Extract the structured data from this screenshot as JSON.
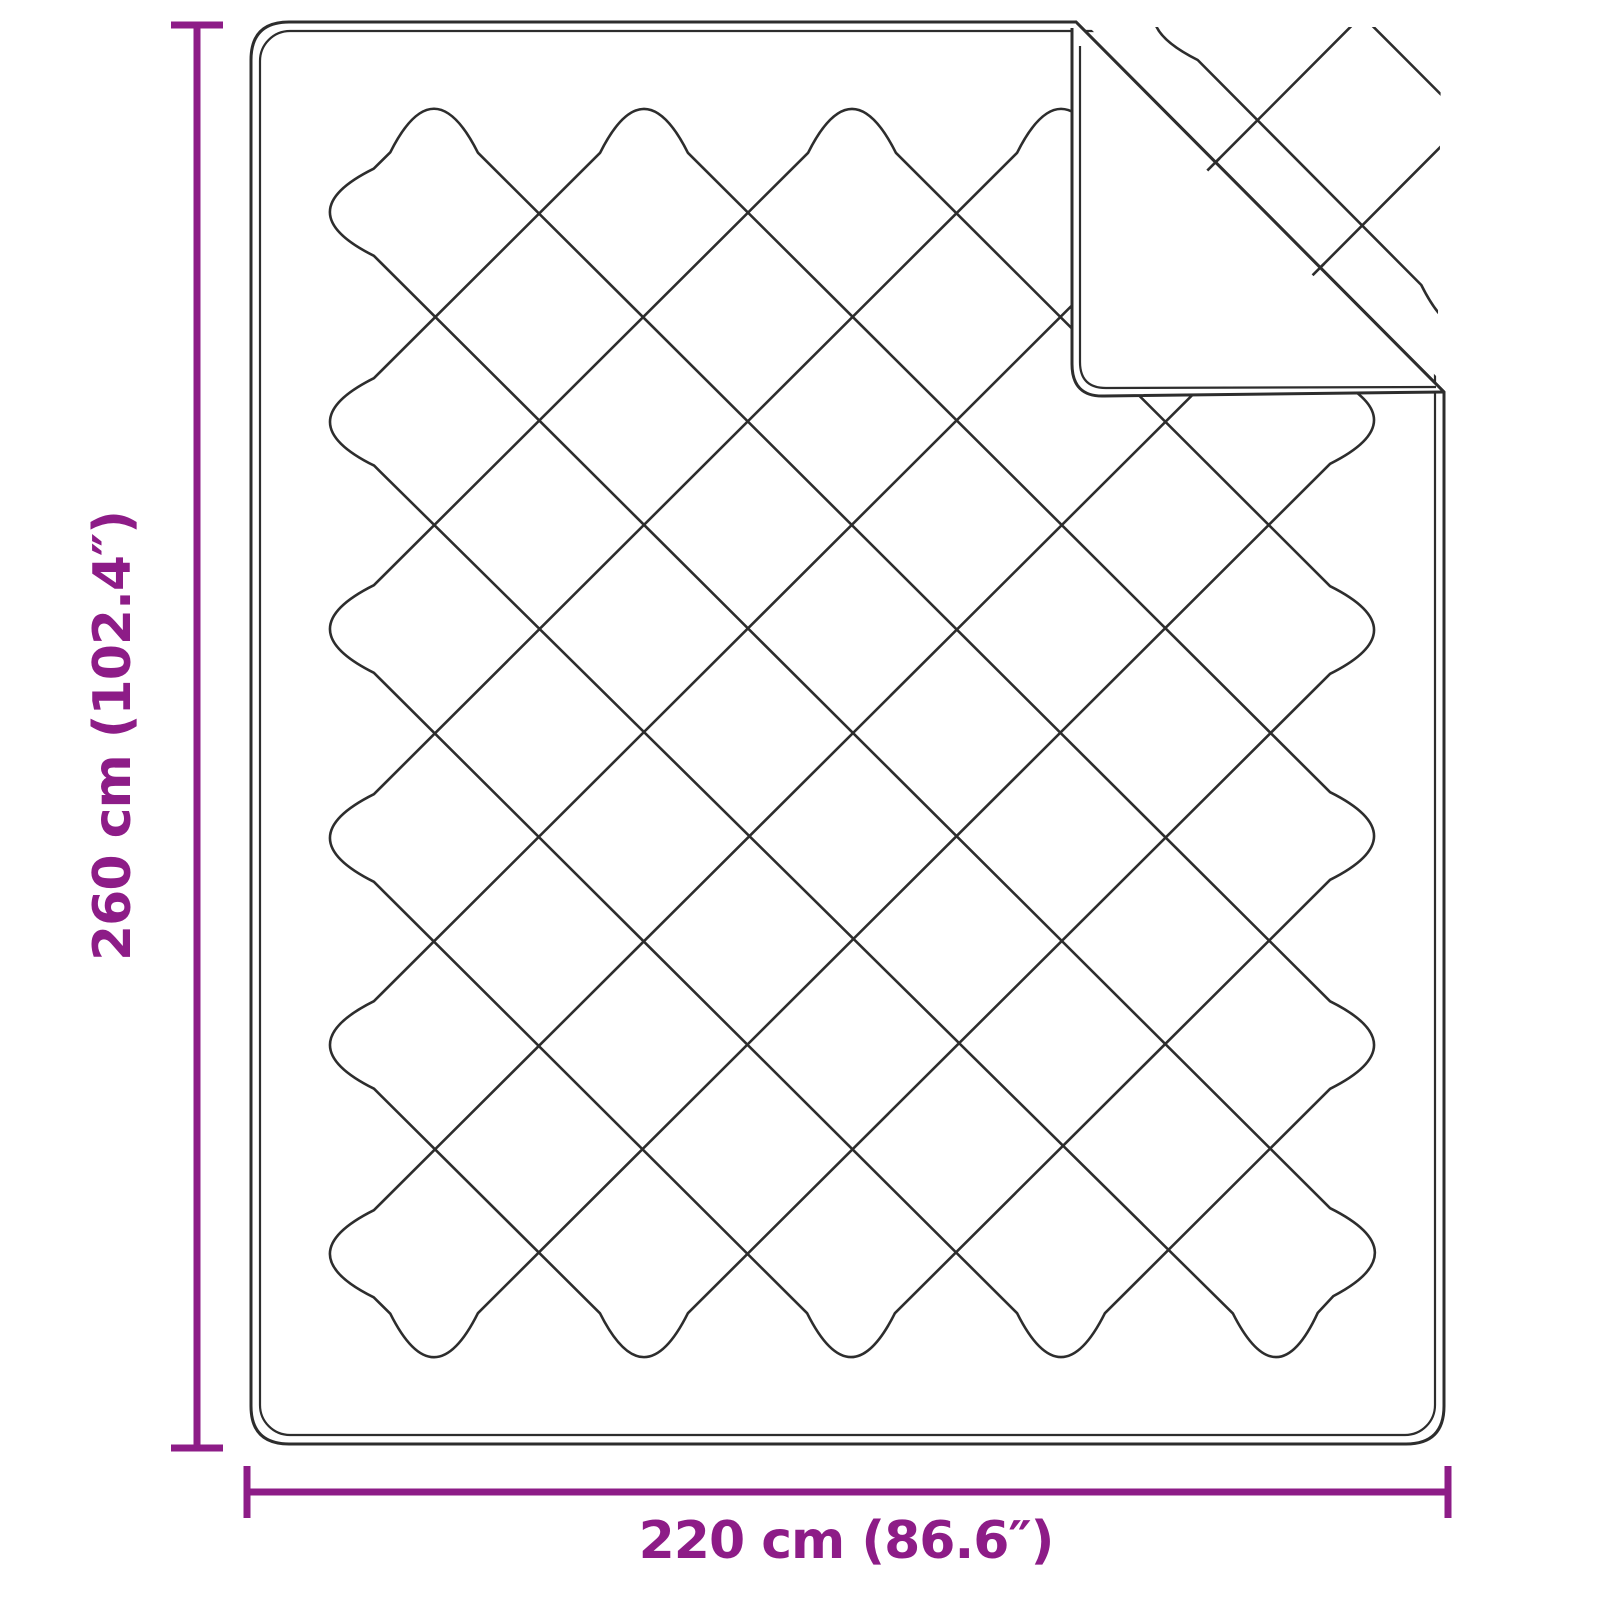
{
  "page": {
    "background": "#ffffff"
  },
  "diagram": {
    "type": "product-dimension-diagram",
    "subject": "quilted blanket with folded back corner",
    "line_color": "#2d2d2d",
    "accent_color": "#8d1c87"
  },
  "dimensions": {
    "height": {
      "label": "260 cm (102.4″)"
    },
    "width": {
      "label": "220 cm (86.6″)"
    }
  },
  "geometry": {
    "canvas": {
      "w": 1600,
      "h": 1600
    },
    "blanket": {
      "left": 251,
      "top": 22,
      "right": 1444,
      "bottom": 1444,
      "corner_r": 38,
      "inset": 9,
      "inner_r": 30
    },
    "crease": {
      "x1": 1076,
      "y1": 22,
      "x2": 1444,
      "y2": 392
    },
    "flap": {
      "left_x": 1072,
      "bottom_y": 396,
      "corner_r": 32,
      "inner_offset": 8
    },
    "pattern": {
      "walls": {
        "L": 330,
        "R": 1374,
        "T": 109,
        "B": 1357
      },
      "cut": 62,
      "bulge": 44,
      "stroke_w": 2.6,
      "mirror_line": 1045,
      "bounces": [
        [
          "T",
          434
        ],
        [
          "R",
          1045
        ],
        [
          "B",
          1061
        ],
        [
          "L",
          629
        ],
        [
          "T",
          852
        ],
        [
          "R",
          630
        ],
        [
          "B",
          644
        ],
        [
          "L",
          1045
        ],
        [
          "T",
          1269
        ],
        [
          "R",
          214
        ],
        [
          "L",
          1254
        ],
        [
          "B",
          434
        ],
        [
          "R",
          420
        ],
        [
          "T",
          1061
        ],
        [
          "L",
          838
        ],
        [
          "B",
          851
        ],
        [
          "R",
          836
        ],
        [
          "T",
          644
        ],
        [
          "L",
          422
        ],
        [
          "B",
          1277
        ],
        [
          "R",
          1252
        ],
        [
          "L",
          212
        ]
      ]
    },
    "dim_v": {
      "x": 197,
      "y1": 25,
      "y2": 1448,
      "cap": 26,
      "w": 7,
      "label_x": 130,
      "label_y": 736
    },
    "dim_h": {
      "y": 1492,
      "x1": 247,
      "x2": 1448,
      "cap": 26,
      "w": 7,
      "label_x": 846,
      "label_y": 1558
    },
    "label_font_size": 52
  }
}
